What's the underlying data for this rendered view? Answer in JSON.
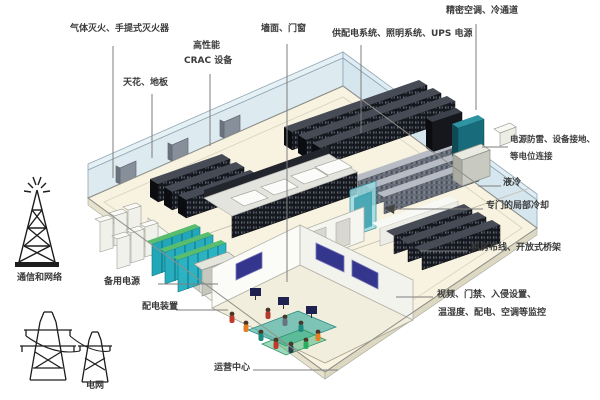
{
  "diagram": {
    "type": "isometric data center room illustration with callout labels",
    "labels": {
      "gas_fire": "气体灭火、手提式灭火器",
      "crac_line1": "高性能",
      "crac_line2": "CRAC 设备",
      "ceiling_floor": "天花、地板",
      "wall_doors": "墙面、门窗",
      "power_supply": "供配电系统、照明系统、UPS 电源",
      "precision_ac": "精密空调、冷通道",
      "surge_line1": "电源防雷、设备接地、",
      "surge_line2": "等电位连接",
      "liquid_cooling": "液冷",
      "local_cooling": "专门的局部冷却",
      "cabling": "机房布线、开放式桥架",
      "monitoring_line1": "视频、门禁、入侵设置、",
      "monitoring_line2": "温湿度、配电、空调等监控",
      "comm_network": "通信和网络",
      "backup_power": "备用电源",
      "power_distribution": "配电装置",
      "power_grid": "电网",
      "operations_center": "运营中心"
    },
    "icons": {
      "left_top": "radio-tower-icon",
      "left_bottom": "power-pylon-icon"
    },
    "colors": {
      "floor": "#f8f3e1",
      "glass_wall": "#d7e7ef",
      "rack_black": "#15181e",
      "rack_gray": "#666d78",
      "crac_teal": "#176b7a",
      "louver_teal": "#22a7b8",
      "cabinet_white": "#f1f1ec",
      "screen_navy": "#33368c",
      "label_text": "#3b3b3b",
      "leader_line": "#7d7d7d"
    }
  }
}
